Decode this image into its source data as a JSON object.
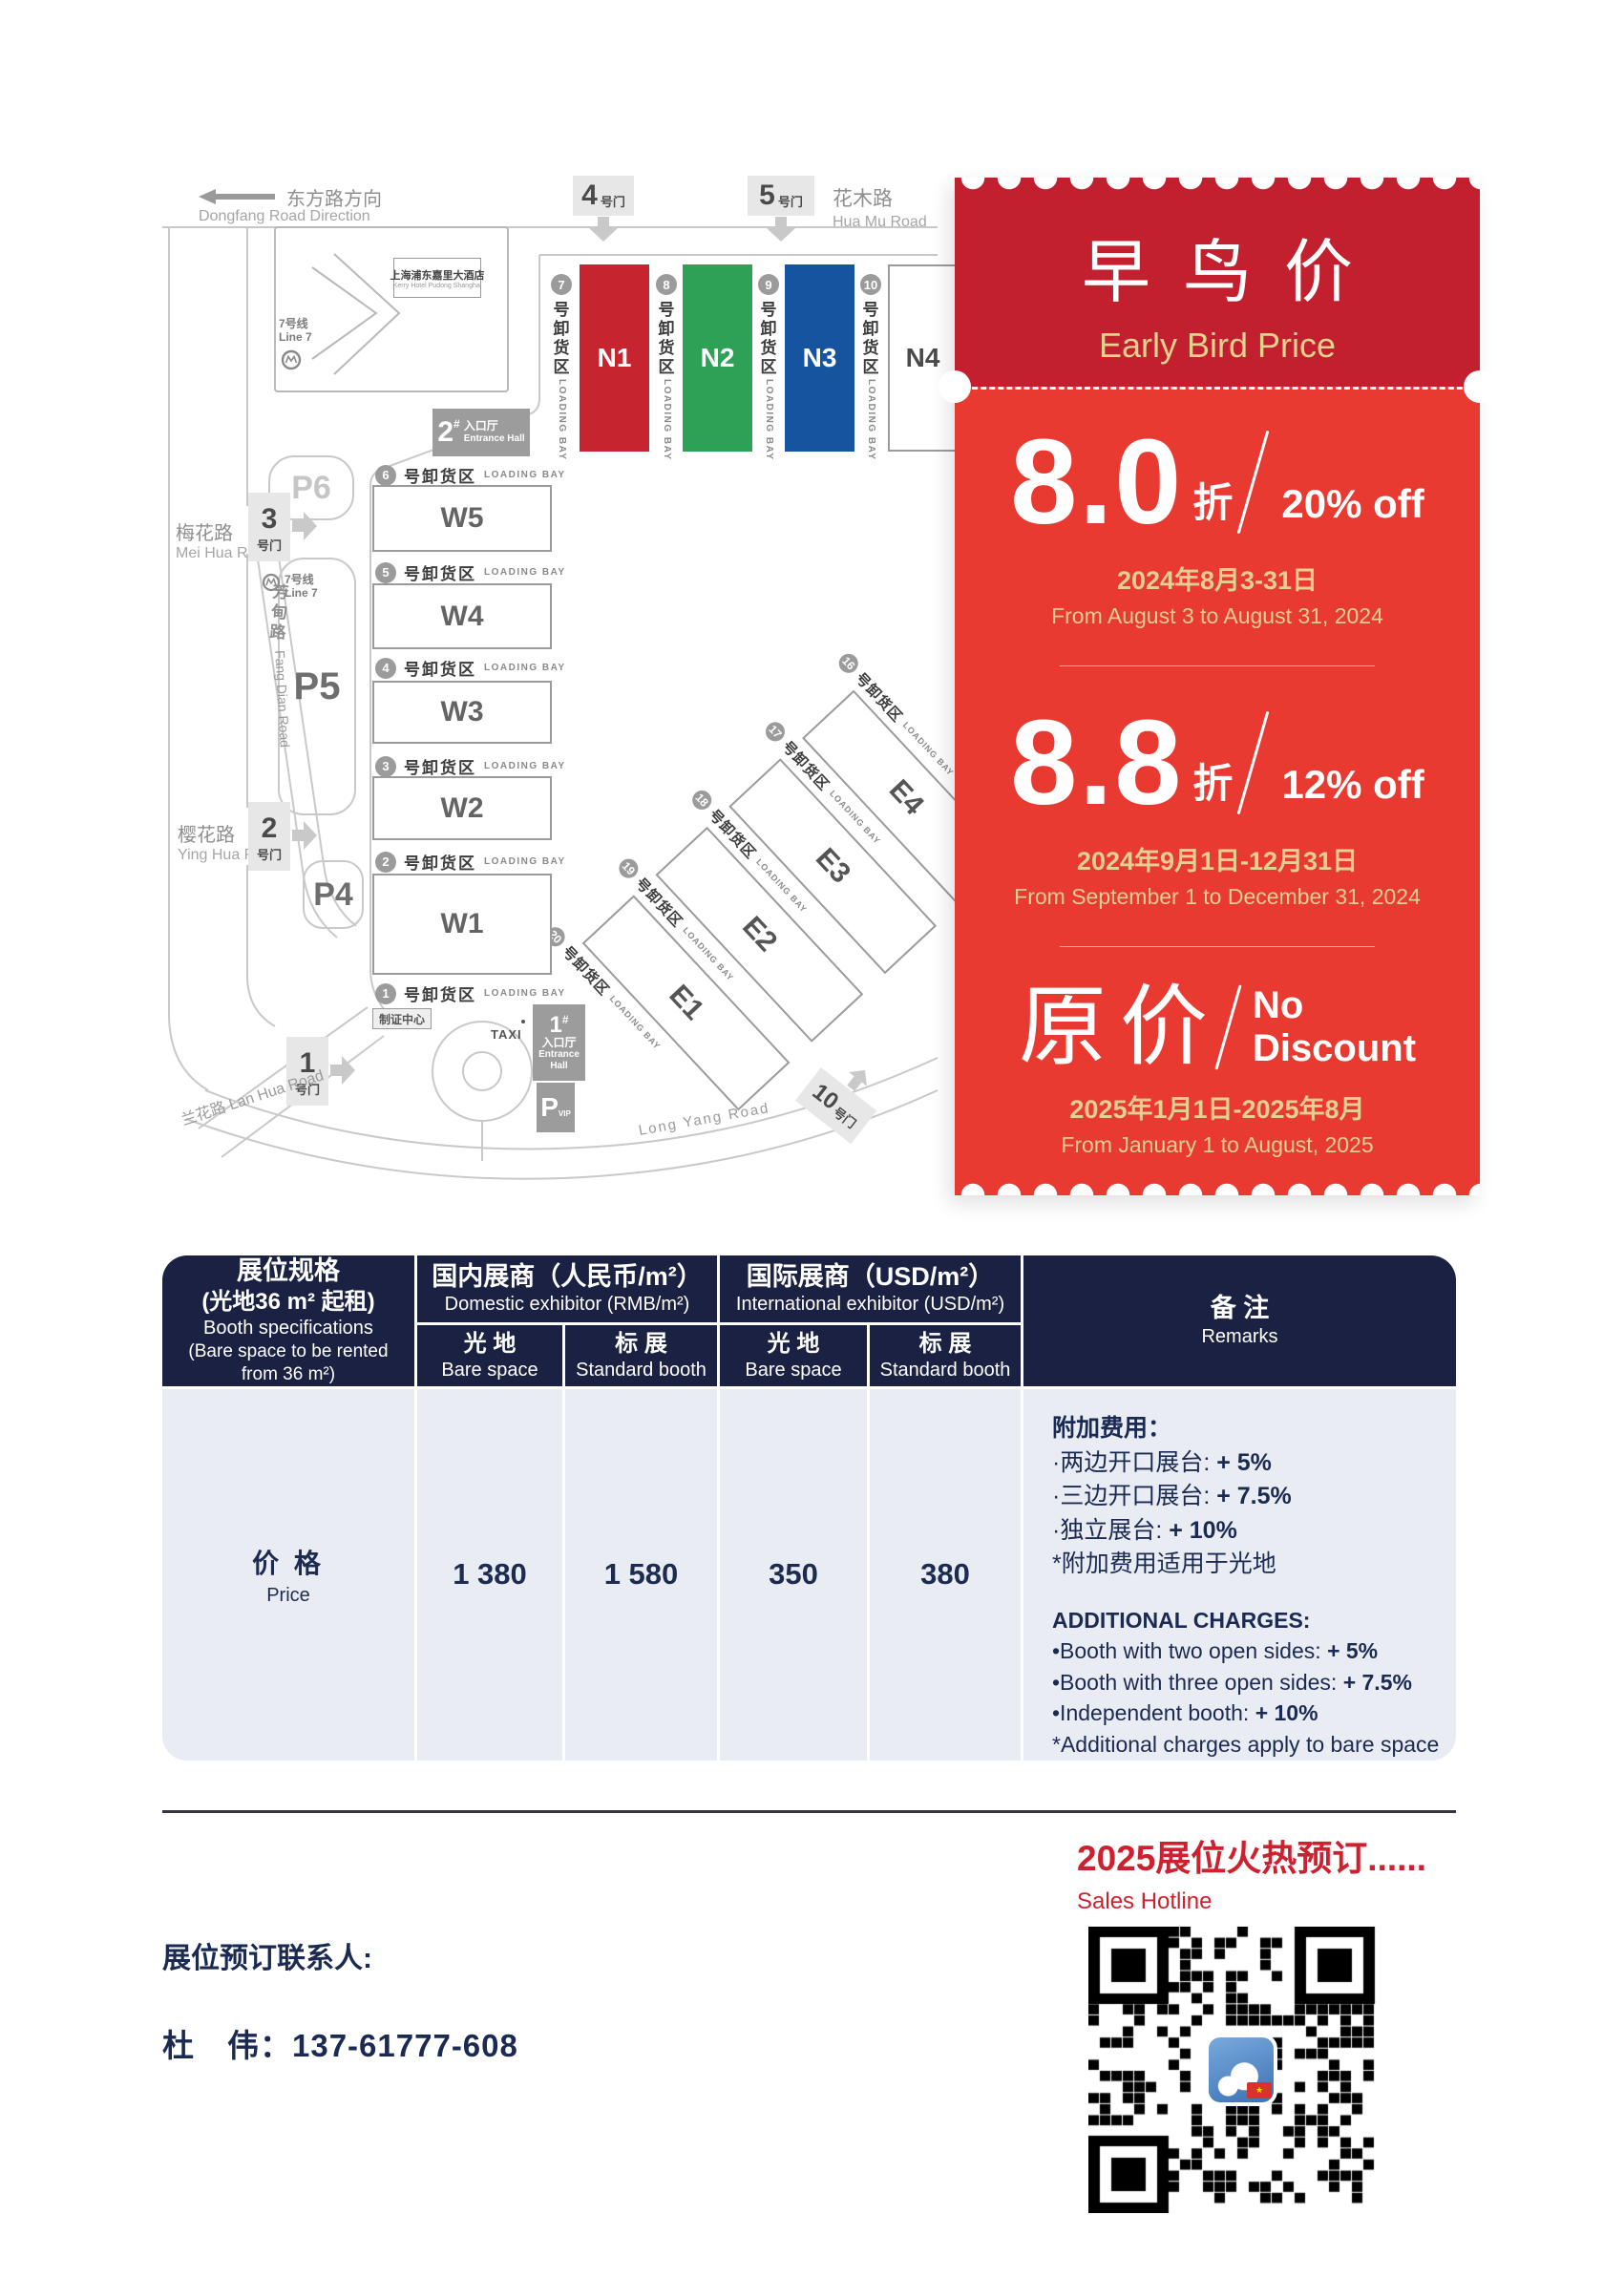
{
  "map": {
    "dongfang": {
      "cn": "东方路方向",
      "en": "Dongfang Road Direction"
    },
    "roads": {
      "huamu_cn": "花木路",
      "huamu_en": "Hua Mu Road",
      "meihua_cn": "梅花路",
      "meihua_en": "Mei Hua Road",
      "fangdian_cn": "芳甸路",
      "fangdian_en": "Fang Dian Road",
      "yinghua_cn": "樱花路",
      "yinghua_en": "Ying Hua Road",
      "lanhua": "兰花路 Lan Hua Road",
      "longyang_en": "Long Yang Road"
    },
    "gate_suffix": "号门",
    "gates": {
      "g4": "4",
      "g5": "5",
      "g3": "3",
      "g2": "2",
      "g1": "1",
      "g10": "10"
    },
    "kerry_cn": "上海浦东嘉里大酒店",
    "kerry_en": "Kerry Hotel Pudong Shanghai",
    "line7_cn": "7号线",
    "line7_en": "Line 7",
    "parking": {
      "p6": "P6",
      "p5": "P5",
      "p4": "P4",
      "pvip": "P",
      "pvip_sub": "VIP"
    },
    "entrance2": {
      "num": "2",
      "hash": "#",
      "cn": "入口厅",
      "en": "Entrance Hall"
    },
    "entrance1": {
      "num": "1",
      "hash": "#",
      "cn": "入口厅",
      "en1": "Entrance",
      "en2": "Hall"
    },
    "badge_center": "制证中心",
    "taxi": "TAXI",
    "loading_cn": "号卸货区",
    "loading_en": "LOADING BAY",
    "w_halls": [
      {
        "bay": "6",
        "name": "W5"
      },
      {
        "bay": "5",
        "name": "W4"
      },
      {
        "bay": "4",
        "name": "W3"
      },
      {
        "bay": "3",
        "name": "W2"
      },
      {
        "bay": "2",
        "name": "W1"
      }
    ],
    "bay1": "1",
    "n_halls": [
      {
        "bay": "7",
        "name": "N1",
        "color": "#c6242e",
        "text": "#ffffff"
      },
      {
        "bay": "8",
        "name": "N2",
        "color": "#2fa156",
        "text": "#ffffff"
      },
      {
        "bay": "9",
        "name": "N3",
        "color": "#17549f",
        "text": "#ffffff"
      },
      {
        "bay": "10",
        "name": "N4",
        "color": "#ffffff",
        "text": "#4a4a4a"
      }
    ],
    "e_halls": [
      {
        "bay": "16",
        "name": "E4"
      },
      {
        "bay": "17",
        "name": "E3"
      },
      {
        "bay": "18",
        "name": "E2"
      },
      {
        "bay": "19",
        "name": "E1"
      }
    ],
    "bay20": "20"
  },
  "coupon": {
    "title": "早鸟价",
    "subtitle": "Early Bird Price",
    "tiers": [
      {
        "big": "8.0",
        "unit": "折",
        "off": "20% off",
        "date_cn": "2024年8月3-31日",
        "date_en": "From August 3 to August 31, 2024"
      },
      {
        "big": "8.8",
        "unit": "折",
        "off": "12% off",
        "date_cn": "2024年9月1日-12月31日",
        "date_en": "From September 1 to December 31, 2024"
      },
      {
        "big": "原价",
        "off_lines": [
          "No",
          "Discount"
        ],
        "date_cn": "2025年1月1日-2025年8月",
        "date_en": "From January 1 to August, 2025"
      }
    ]
  },
  "price_table": {
    "col1": {
      "cn1": "展位规格",
      "cn2": "(光地36 m² 起租)",
      "en1": "Booth specifications",
      "en2": "(Bare space to be rented",
      "en3": "from 36 m²)"
    },
    "domestic": {
      "cn": "国内展商（人民币/m²）",
      "en": "Domestic exhibitor (RMB/m²)"
    },
    "intl": {
      "cn": "国际展商（USD/m²）",
      "en": "International exhibitor (USD/m²)"
    },
    "sub": {
      "bare_cn": "光 地",
      "bare_en": "Bare space",
      "std_cn": "标 展",
      "std_en": "Standard booth"
    },
    "remarks_hdr": {
      "cn": "备 注",
      "en": "Remarks"
    },
    "row": {
      "label_cn": "价 格",
      "label_en": "Price",
      "values": [
        "1 380",
        "1 580",
        "350",
        "380"
      ]
    },
    "remarks": {
      "cn_title": "附加费用：",
      "cn_lines": [
        [
          "·两边开口展台: ",
          "+ 5%"
        ],
        [
          "·三边开口展台: ",
          "+ 7.5%"
        ],
        [
          "·独立展台: ",
          "+ 10%"
        ],
        [
          "*附加费用适用于光地",
          ""
        ]
      ],
      "en_title": "ADDITIONAL CHARGES:",
      "en_lines": [
        [
          "•Booth with two open sides: ",
          "+ 5%"
        ],
        [
          "•Booth with three open sides: ",
          "+ 7.5%"
        ],
        [
          "•Independent booth: ",
          "+ 10%"
        ],
        [
          "*Additional charges apply to bare space",
          ""
        ]
      ]
    }
  },
  "footer": {
    "hotline_cn": "2025展位火热预订......",
    "hotline_en": "Sales Hotline",
    "contact_label": "展位预订联系人:",
    "contact_phone": "杜　伟：137-61777-608",
    "qr_icon": "wechat-qr-code",
    "flag_star": "★"
  },
  "colors": {
    "coupon_dark_red": "#c2202f",
    "coupon_bright_red": "#e93a31",
    "gold": "#e5cf92",
    "table_navy": "#1a2142",
    "table_body_gray": "#e9ecf2",
    "accent_red": "#ce2130",
    "hall_n1": "#c6242e",
    "hall_n2": "#2fa156",
    "hall_n3": "#17549f"
  }
}
